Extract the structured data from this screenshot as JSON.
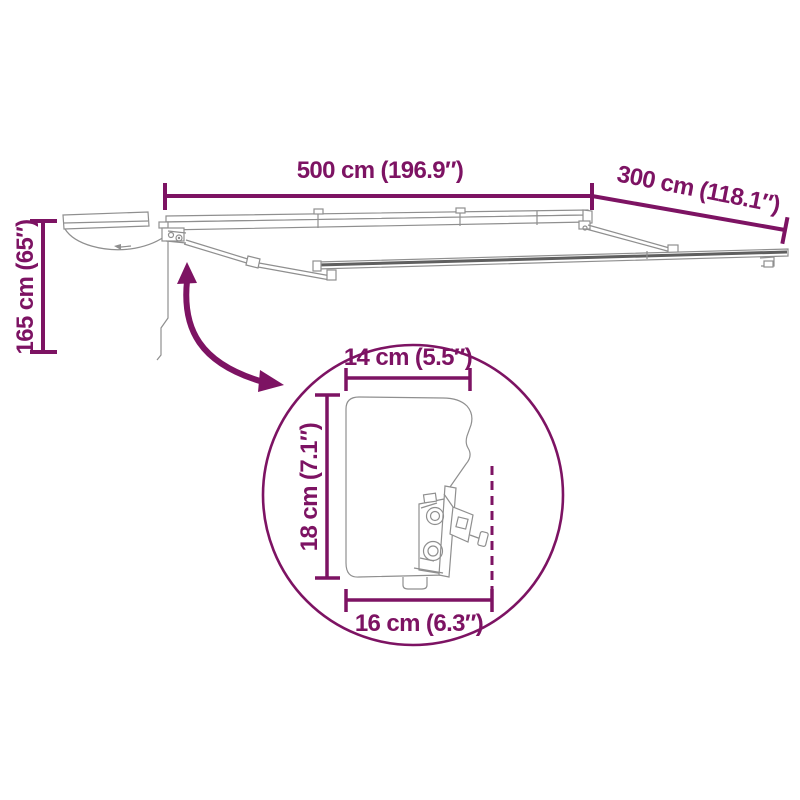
{
  "page": {
    "title": "Retractable awning dimension diagram",
    "background_color": "#FFFFFF"
  },
  "colors": {
    "accent_purple": "#7D1363",
    "line_art_gray": "#8F8F8F",
    "rail_dark_gray": "#5F5F5F"
  },
  "diagram": {
    "type": "product-dimension-diagram",
    "subject": "cassette awning shown extended (frame) and folded, with magnified cross-section detail of the cassette and wall bracket",
    "dimensions": {
      "width": "500 cm (196.9″)",
      "depth": "300 cm (118.1″)",
      "height": "165 cm (65″)"
    },
    "detail": {
      "cassette_width": "14 cm (5.5″)",
      "cassette_height": "18 cm (7.1″)",
      "cassette_depth": "16 cm (6.3″)"
    }
  }
}
